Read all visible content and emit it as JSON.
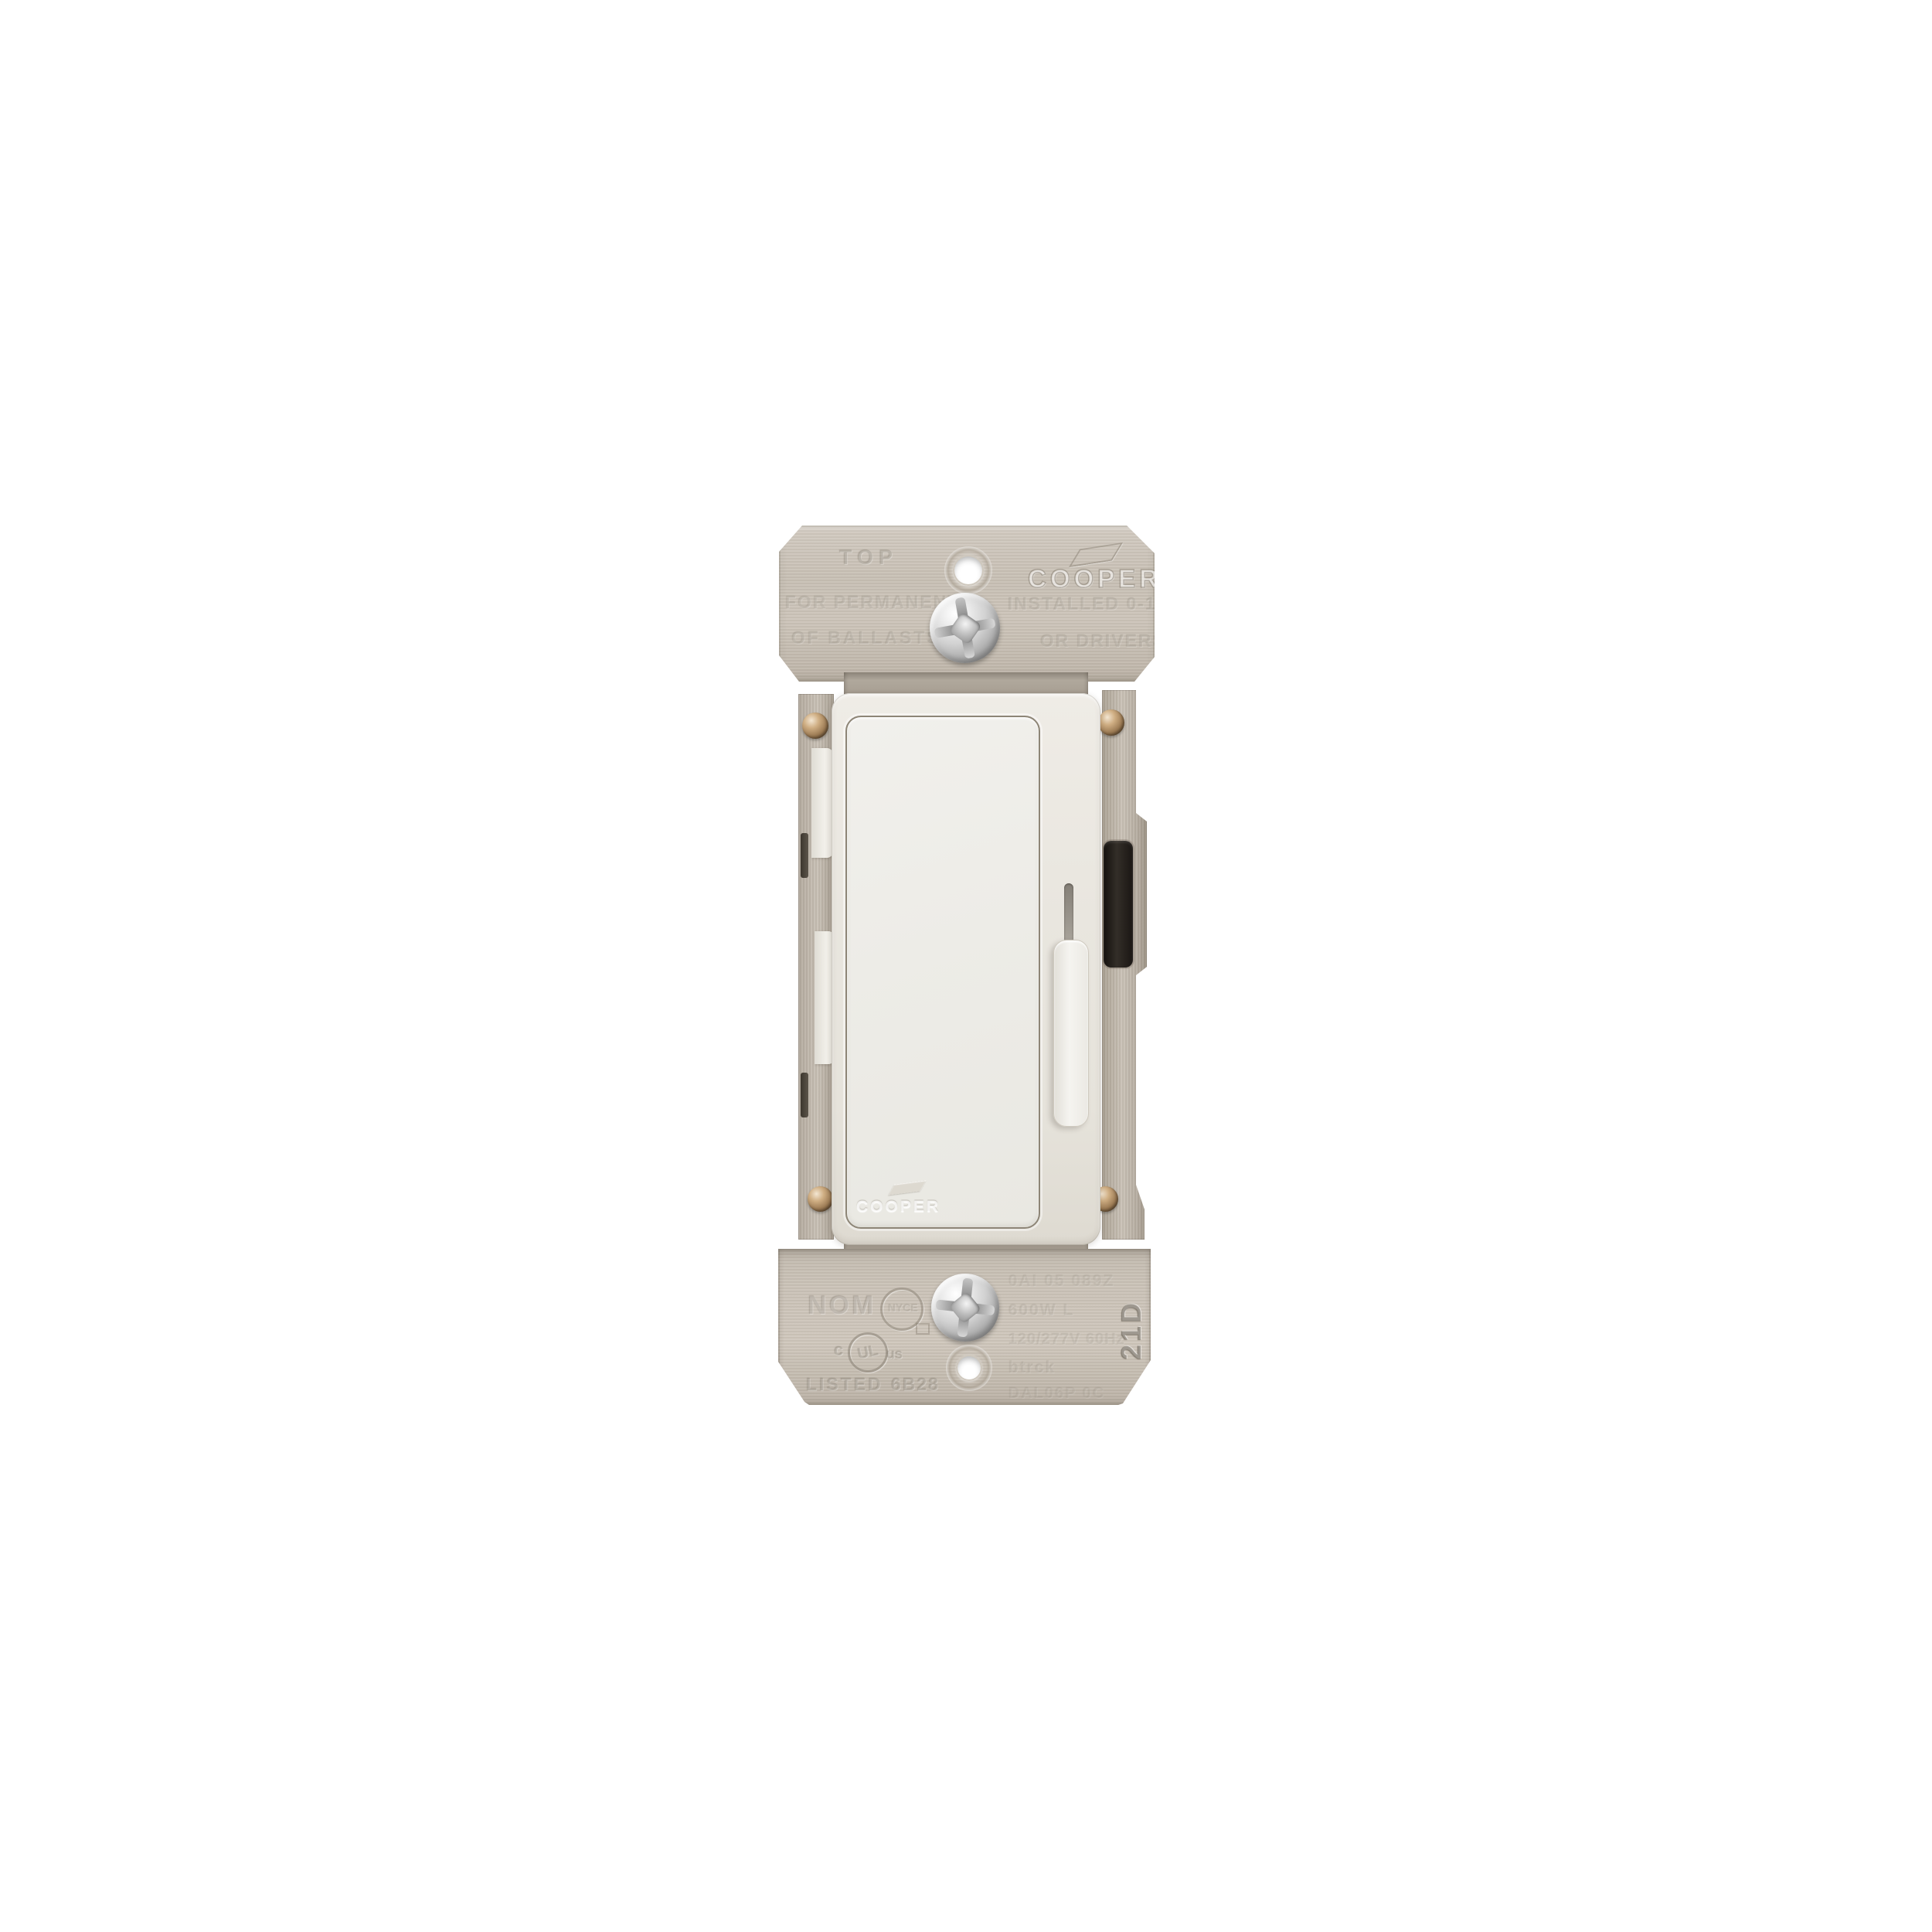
{
  "product": {
    "name": "Cooper decorator slide dimmer switch",
    "colors": {
      "background": "#ffffff",
      "metal_strap": "#c6beb3",
      "device_body": "#eae7e0",
      "paddle": "#efede8",
      "slider_lever": "#f3f2ee",
      "heat_sink": "#1d1a16",
      "bronze_screw": "#96754f",
      "steel_screw": "#c9c9c9"
    },
    "top_strap": {
      "orientation_label": "TOP",
      "brand": "COOPER",
      "line2_left": "FOR PERMANENTL",
      "line2_right": "INSTALLED 0-10",
      "line3_left": "OF BALLASTS",
      "line3_right": "OR DRIVERS"
    },
    "paddle": {
      "brand": "COOPER"
    },
    "bottom_strap": {
      "nom_mark": "NOM",
      "cert_circle_mark": "NYCE",
      "ul_c": "c",
      "ul": "UL",
      "ul_us": "us",
      "listed_label": "LISTED",
      "listed_code": "6B28",
      "side_code": "21D",
      "ratings_rows": [
        "0AI 05 089Z",
        "600W  L",
        "120/277V  60Hz",
        "btrck",
        "DAL06P  0C"
      ]
    }
  }
}
